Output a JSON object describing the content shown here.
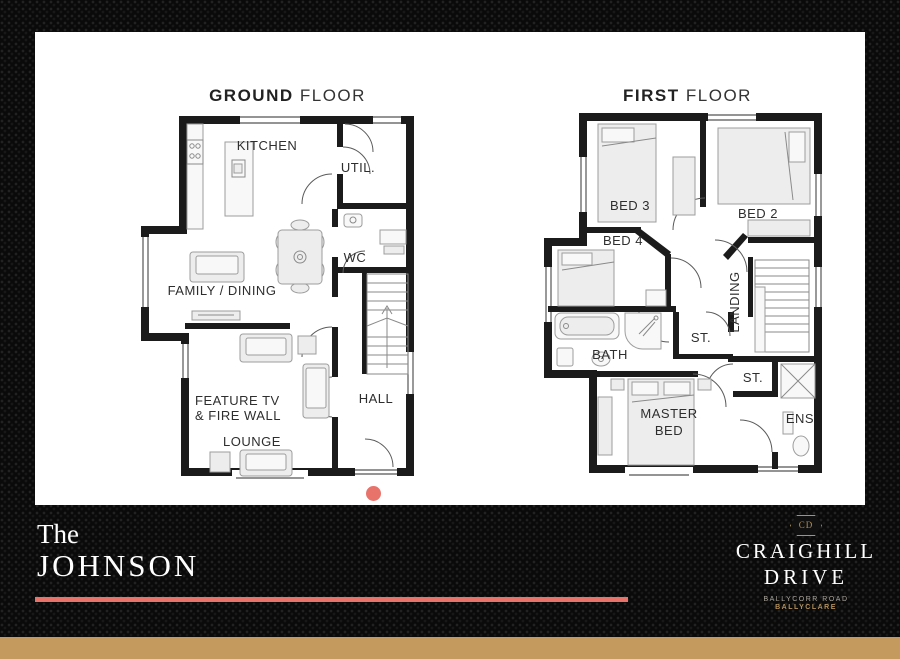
{
  "panel": {
    "ground_floor": {
      "title_bold": "GROUND",
      "title_light": "FLOOR",
      "rooms": {
        "kitchen": "KITCHEN",
        "util": "UTIL.",
        "wc": "WC",
        "family_dining": "FAMILY / DINING",
        "feature_tv_line1": "FEATURE TV",
        "feature_tv_line2": "& FIRE WALL",
        "lounge": "LOUNGE",
        "hall": "HALL"
      }
    },
    "first_floor": {
      "title_bold": "FIRST",
      "title_light": "FLOOR",
      "rooms": {
        "bed3": "BED 3",
        "bed2": "BED 2",
        "bed4": "BED 4",
        "landing": "LANDING",
        "bath": "BATH",
        "st1": "ST.",
        "st2": "ST.",
        "master_line1": "MASTER",
        "master_line2": "BED",
        "ens": "ENS"
      }
    }
  },
  "footer": {
    "house_name_prefix": "The",
    "house_name": "JOHNSON",
    "brand": {
      "monogram": "CD",
      "name_line1": "CRAIGHILL",
      "name_line2": "DRIVE",
      "address_line1": "BALLYCORR ROAD",
      "address_line2": "BALLYCLARE"
    }
  },
  "colors": {
    "accent_coral": "#e8736b",
    "gold_bar": "#c49a5e",
    "gold_text": "#b4905a",
    "wall_black": "#1b1b1b",
    "background": "#0a0a0a"
  }
}
